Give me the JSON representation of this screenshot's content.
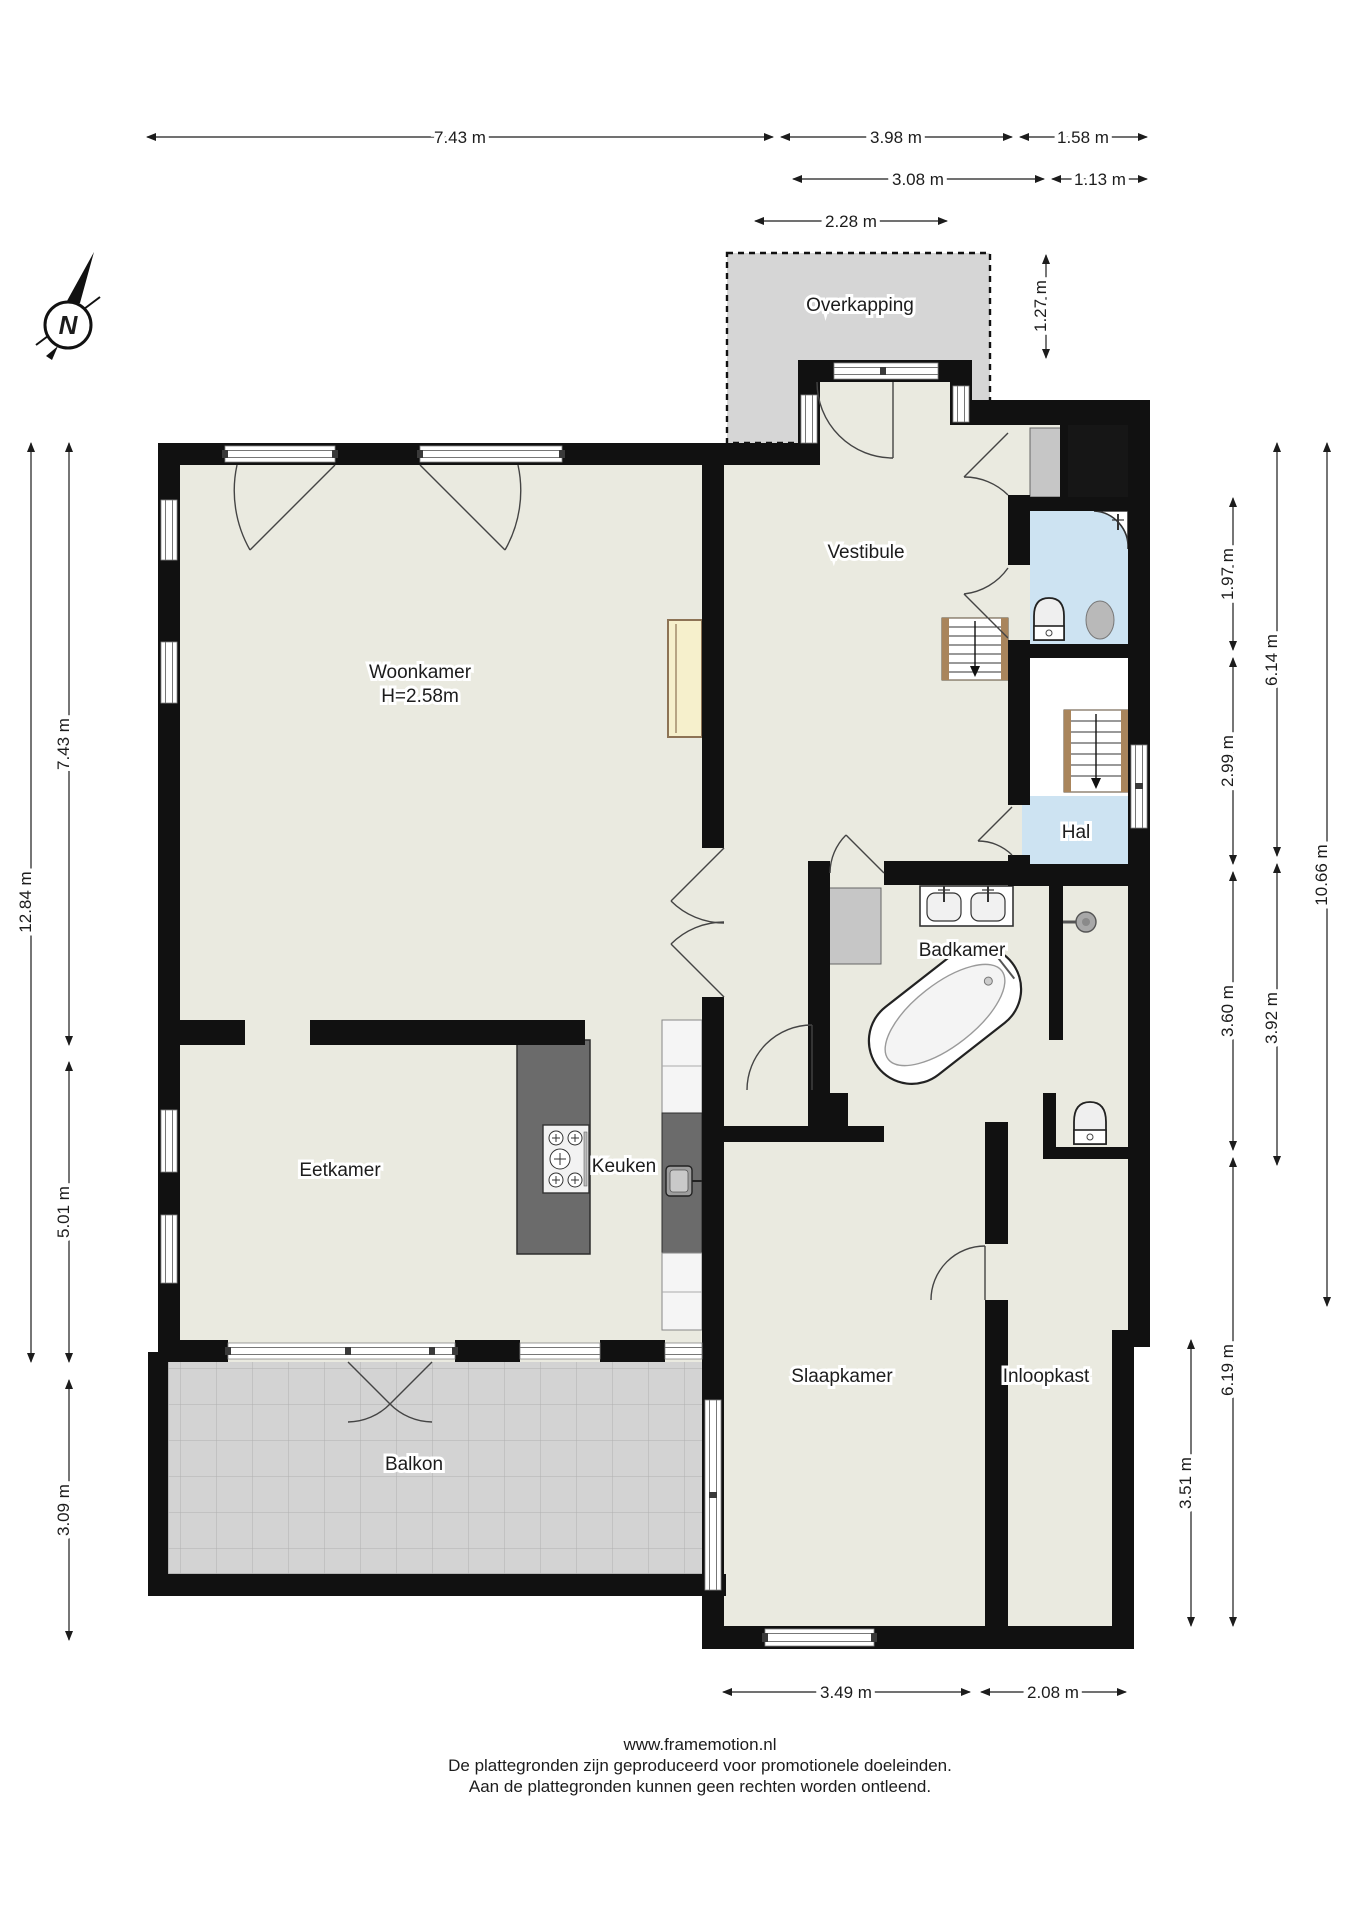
{
  "document": {
    "type": "floorplan",
    "footer": {
      "url": "www.framemotion.nl",
      "line1": "De plattegronden zijn geproduceerd voor promotionele doeleinden.",
      "line2": "Aan de plattegronden kunnen geen rechten worden ontleend."
    }
  },
  "compass": {
    "label": "N"
  },
  "rooms": {
    "overkapping": {
      "label": "Overkapping"
    },
    "vestibule": {
      "label": "Vestibule"
    },
    "woonkamer": {
      "label": "Woonkamer",
      "height": "H=2.58m"
    },
    "hal": {
      "label": "Hal"
    },
    "badkamer": {
      "label": "Badkamer"
    },
    "eetkamer": {
      "label": "Eetkamer"
    },
    "keuken": {
      "label": "Keuken"
    },
    "slaapkamer": {
      "label": "Slaapkamer"
    },
    "inloopkast": {
      "label": "Inloopkast"
    },
    "balkon": {
      "label": "Balkon"
    }
  },
  "dimensions": {
    "top": [
      "7.43 m",
      "3.98 m",
      "1.58 m",
      "3.08 m",
      "1.13 m",
      "2.28 m",
      "1.27 m"
    ],
    "left": [
      "12.84 m",
      "7.43 m",
      "5.01 m",
      "3.09 m"
    ],
    "right": [
      "1.97 m",
      "6.14 m",
      "10.66 m",
      "2.99 m",
      "3.60 m",
      "3.92 m",
      "6.19 m",
      "3.51 m"
    ],
    "bottom": [
      "3.49 m",
      "2.08 m"
    ]
  },
  "colors": {
    "wall": "#111111",
    "floor": "#eaeae0",
    "wet_room": "#cde3f2",
    "outdoor": "#d6d6d6",
    "closet_gray": "#c6c6c6",
    "counter_gray": "#6b6b6b",
    "cabinet_cream": "#f6f0cc",
    "stair_wood": "#a9855c"
  }
}
